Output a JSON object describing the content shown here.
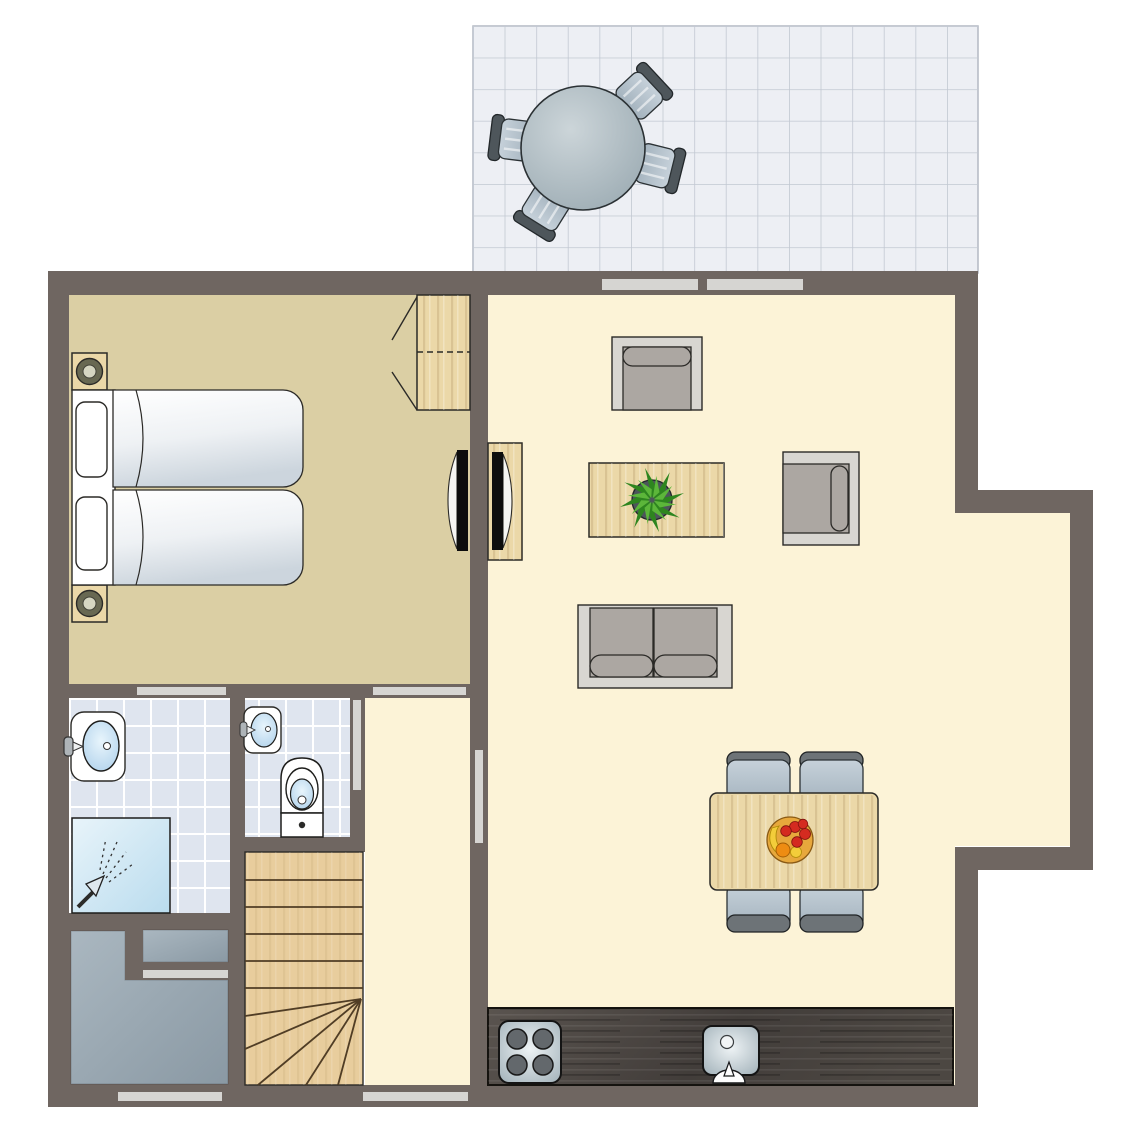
{
  "plan": {
    "type": "floor-plan",
    "title": "Holiday lodge ground floor plan (no text labels rendered in image)",
    "rooms": [
      {
        "name": "terrace",
        "features": [
          "tiled patio grid",
          "round outdoor table",
          "4 outdoor chairs"
        ]
      },
      {
        "name": "bedroom",
        "features": [
          "two single beds pushed together",
          "2 nightstands with lamps",
          "wardrobe with dashed shelf line",
          "wall-mounted tv"
        ]
      },
      {
        "name": "living-room",
        "features": [
          "armchair facing down",
          "armchair facing left",
          "coffee table with potted plant",
          "two-seat sofa",
          "tv cabinet with tv",
          "bay extension on right wall"
        ]
      },
      {
        "name": "dining-area",
        "features": [
          "rectangular wooden table",
          "4 chairs",
          "fruit bowl"
        ]
      },
      {
        "name": "kitchen",
        "features": [
          "dark counter along bottom wall",
          "4-burner hob",
          "sink with faucet"
        ]
      },
      {
        "name": "bathroom",
        "features": [
          "washbasin with faucet",
          "shower with spray symbol",
          "tiled floor"
        ]
      },
      {
        "name": "toilet-room",
        "features": [
          "small washbasin",
          "toilet",
          "tiled floor"
        ]
      },
      {
        "name": "hallway",
        "features": [
          "door openings to bedroom, bathroom, toilet and living room"
        ]
      },
      {
        "name": "staircase",
        "features": [
          "straight treads",
          "winder treads fanning to lower-right point"
        ]
      },
      {
        "name": "storage-closet",
        "features": [
          "gray storage units"
        ]
      }
    ],
    "openings": {
      "terrace_sliding_doors": 2,
      "bottom_wall_windows": 2,
      "interior_door_thresholds": [
        "bedroom",
        "bathroom",
        "toilet",
        "living-room",
        "closet"
      ]
    },
    "colors": {
      "background": "#ffffff",
      "wall": "#6f6661",
      "bedroom_floor": "#dbcfa4",
      "living_floor": "#fcf3d7",
      "hall_floor": "#fcf3d7",
      "tile_floor": "#dfe5ef",
      "tile_grout": "#ffffff",
      "terrace_floor": "#edeff4",
      "terrace_grid": "#c2c8d2",
      "door_strip": "#d6d5d2",
      "wood": "#ebd8a8",
      "stairs": "#e8cd9d",
      "stair_line": "#503d25",
      "counter": "#474340",
      "steel": "#c3ced4",
      "gray_box": "#9aa9b3",
      "frame": "#d8d6d1",
      "cushion": "#aca7a2",
      "outline": "#2b2a27",
      "chair_seat": "#b9c5ce",
      "chair_back": "#6d7377",
      "terrace_chair_back": "#4e565b",
      "basin": "#bcd9ee",
      "shower": "#cfe6f3",
      "plant_dark": "#2e851f",
      "plant_light": "#5cb63a",
      "pot": "#4d555b",
      "tv": "#0d0d0d",
      "fixture_white": "#ffffff",
      "fruit_bowl": "#e7a83c",
      "fruit_red": "#d42b20",
      "fruit_orange": "#ee8c12",
      "fruit_yellow": "#f3cd3a"
    }
  }
}
